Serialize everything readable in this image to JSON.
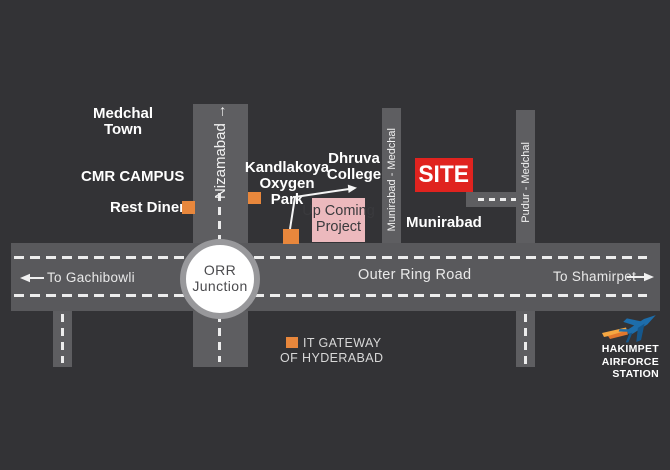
{
  "map_title": "site location map",
  "colors": {
    "background": "#333336",
    "road_gray": "#5A5A5D",
    "dash_white": "#EDEDED",
    "marker_orange": "#E8873C",
    "site_red": "#E0231F",
    "project_pink": "#ECB9BD",
    "junction_ring_gray": "#98989B",
    "jet_blue": "#1D6DAB",
    "flame_orange": "#F09B3D"
  },
  "roads": {
    "nizamabad_label": "Nizamabad →",
    "munirabad_medchal_label": "Munirabad - Medchal",
    "pudur_medchal_label": "Pudur - Medchal",
    "outer_ring_road_label": "Outer Ring Road",
    "to_gachibowli": "To Gachibowli",
    "to_shamirpet": "To Shamirpet",
    "junction_line1": "ORR",
    "junction_line2": "Junction"
  },
  "places": {
    "medchal_town_line1": "Medchal",
    "medchal_town_line2": "Town",
    "cmr_campus": "CMR CAMPUS",
    "rest_diner": "Rest Diner",
    "kandlakoya_line1": "Kandlakoya",
    "kandlakoya_line2": "Oxygen Park",
    "dhruva_line1": "Dhruva",
    "dhruva_line2": "College",
    "upcoming_line1": "Up Coming",
    "upcoming_line2": "Project",
    "site": "SITE",
    "munirabad": "Munirabad",
    "it_gateway_line1": "IT GATEWAY",
    "it_gateway_line2": "OF HYDERABAD",
    "hakimpet_line1": "HAKIMPET",
    "hakimpet_line2": "AIRFORCE STATION"
  }
}
